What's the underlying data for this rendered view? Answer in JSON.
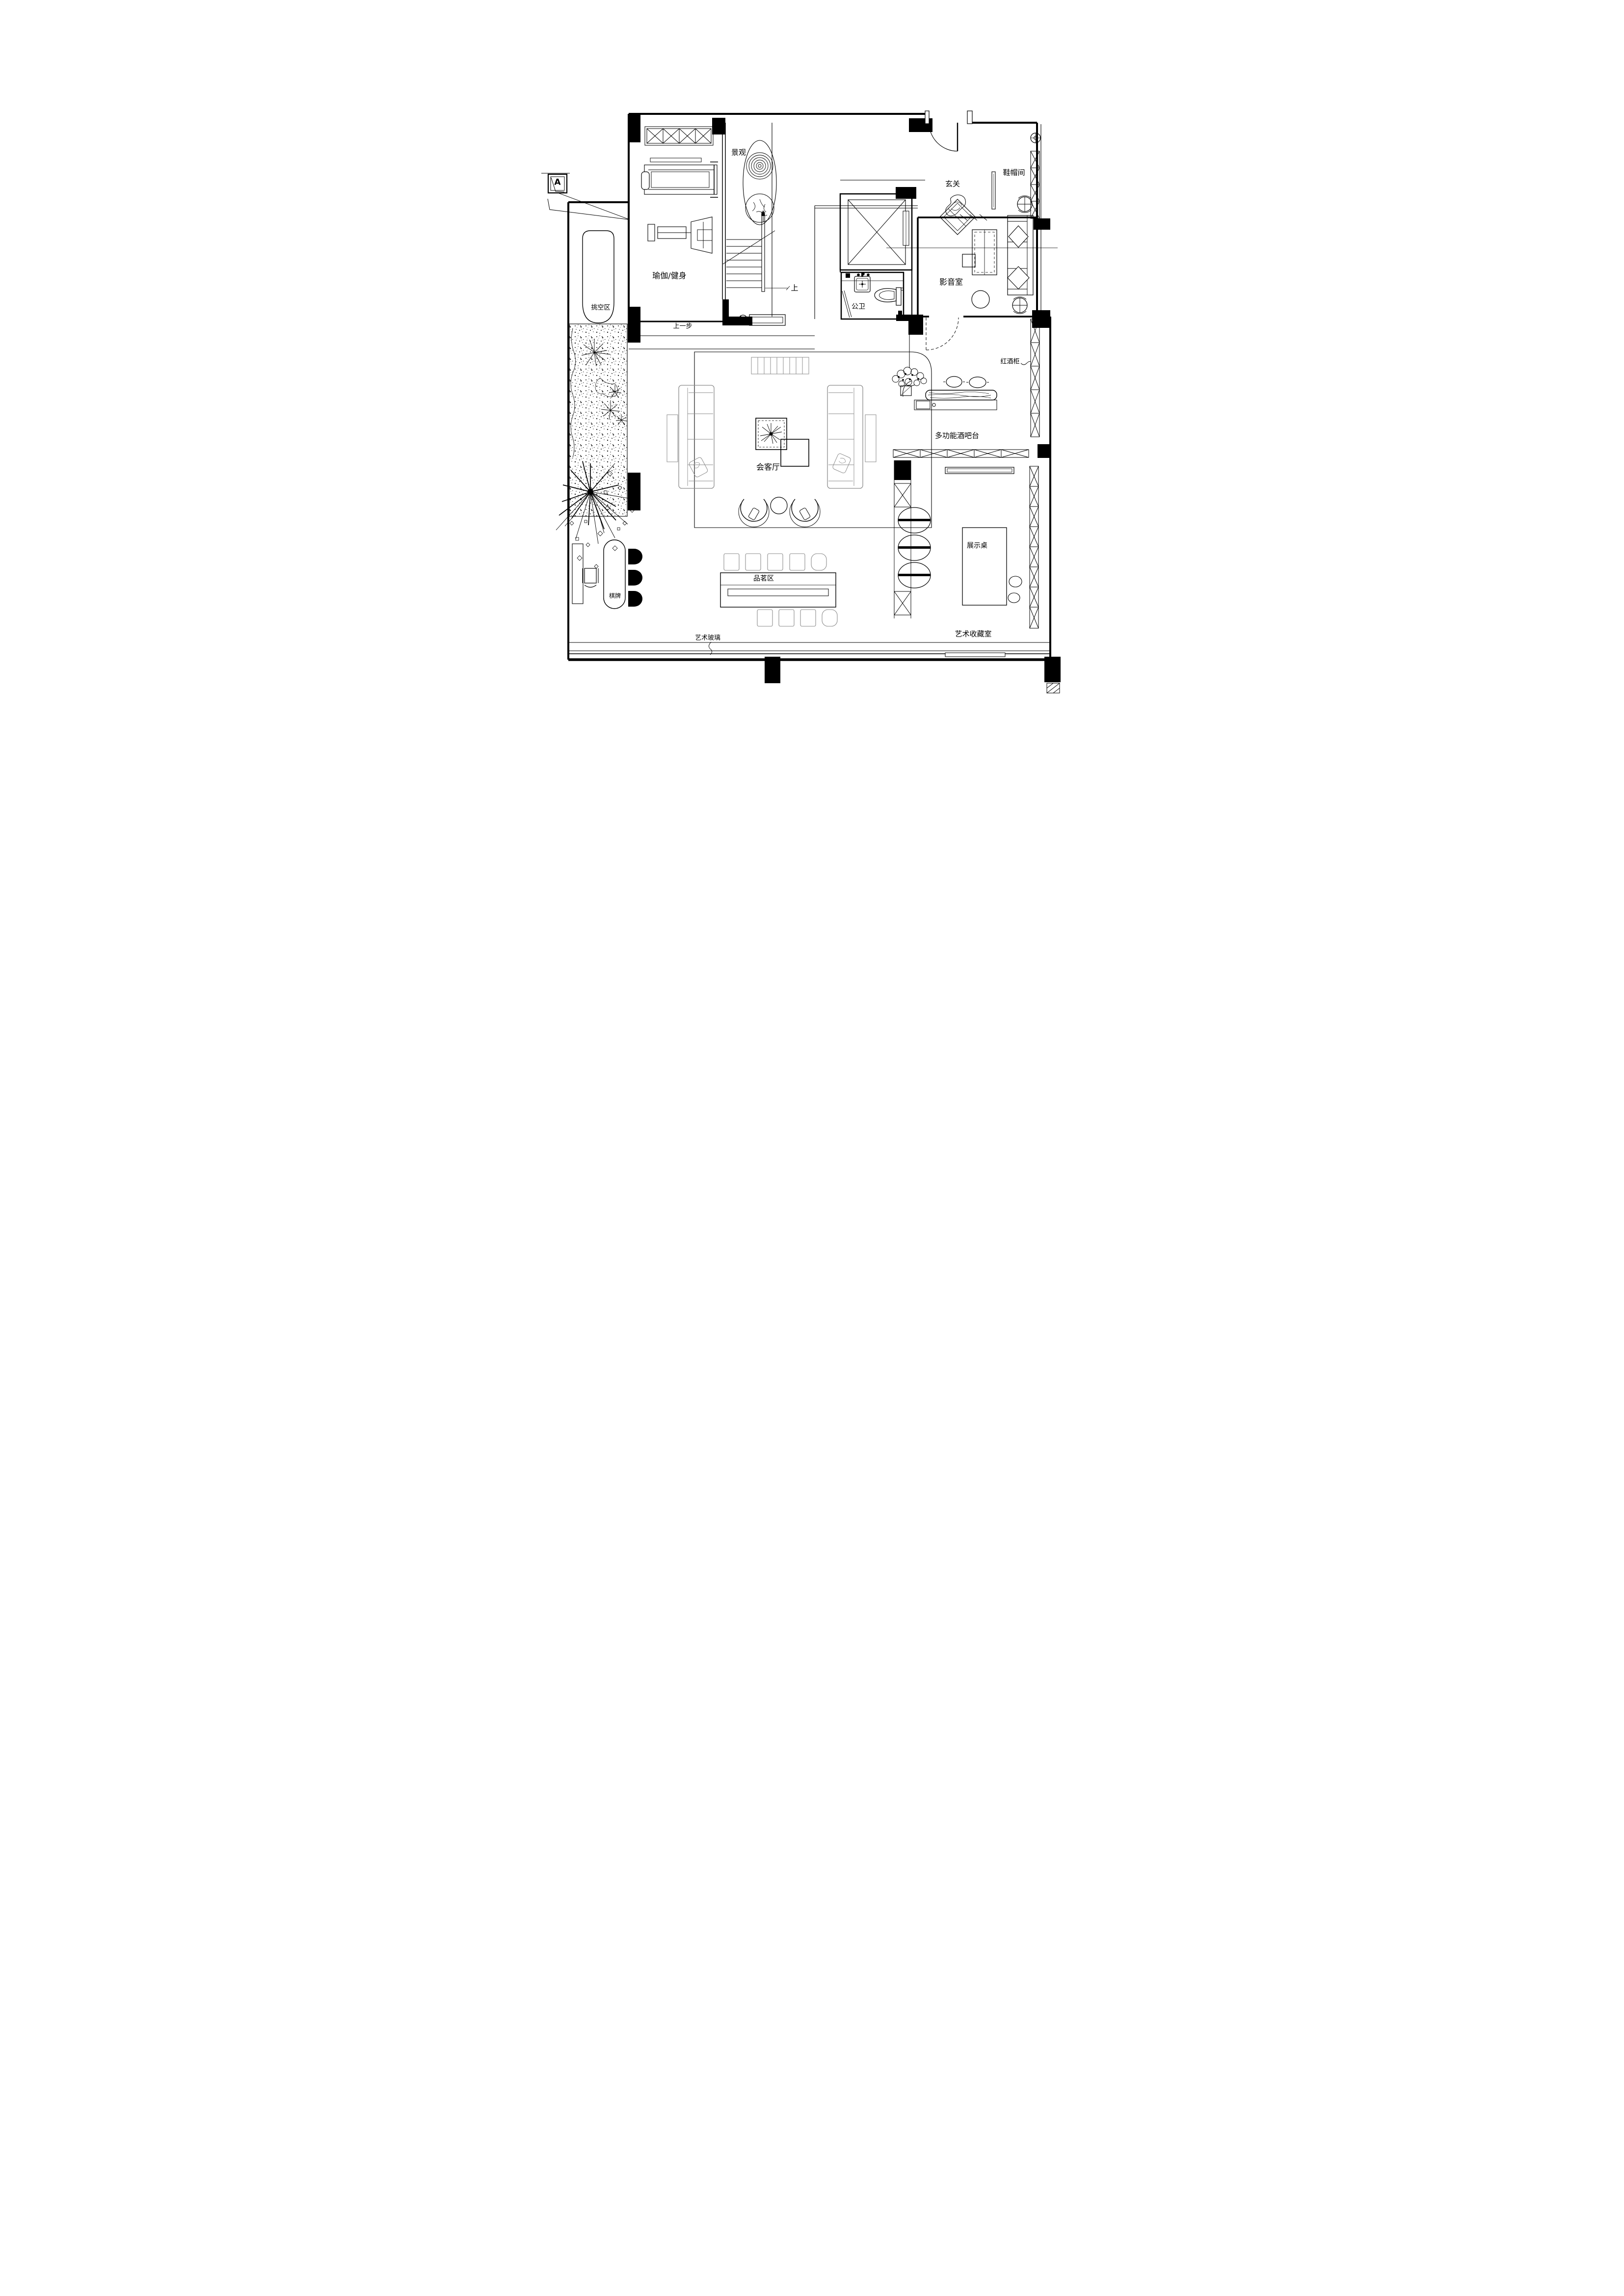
{
  "document": {
    "type": "residential floor plan",
    "style": "black-and-white CAD line drawing",
    "background_color": "#ffffff",
    "line_color": "#000000",
    "furniture_line_color": "#8c8c8c"
  },
  "labels": {
    "landscape": "景观",
    "entry": "玄关",
    "shoe_hat_room": "鞋帽间",
    "home_theater": "影音室",
    "public_restroom": "公卫",
    "wine_cabinet": "红酒柜",
    "multifunction_bar": "多功能酒吧台",
    "reception_hall": "会客厅",
    "display_table": "展示桌",
    "chess_cards": "棋牌",
    "tea_area": "品茗区",
    "art_collection": "艺术收藏室",
    "art_glass": "艺术玻璃",
    "void_area": "挑空区",
    "yoga_fitness": "瑜伽/健身",
    "up": "上",
    "step_up": "上一步",
    "section_marker": "A"
  }
}
